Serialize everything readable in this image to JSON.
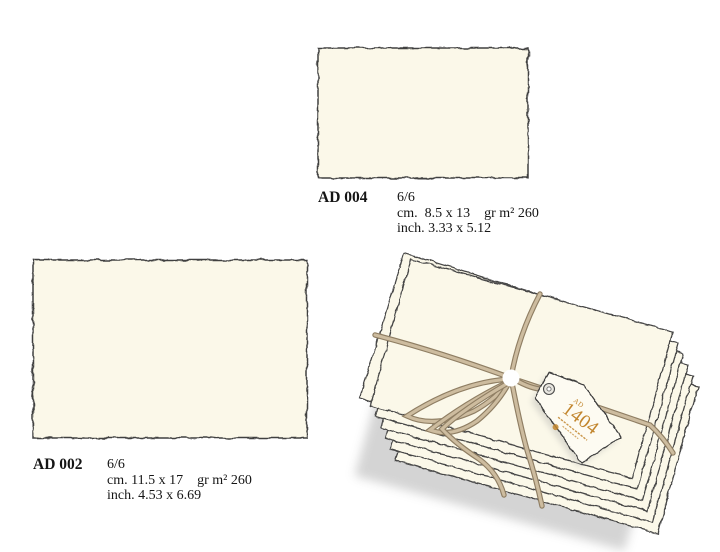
{
  "products": [
    {
      "code": "AD 004",
      "count": "6/6",
      "size_cm": "cm.  8.5 x 13",
      "weight": "gr m² 260",
      "size_inch": "inch. 3.33 x 5.12"
    },
    {
      "code": "AD 002",
      "count": "6/6",
      "size_cm": "cm. 11.5 x 17",
      "weight": "gr m² 260",
      "size_inch": "inch. 4.53 x 6.69"
    }
  ],
  "bundle_tag": {
    "prefix": "AD",
    "number": "1404"
  },
  "colors": {
    "paper_cream": "#FBF8E9",
    "ink_outline": "#464646",
    "twine_light": "#CDBC9F",
    "twine_dark": "#8F7E63",
    "tag_text_orange": "#C2862E",
    "background": "#FFFFFF"
  }
}
